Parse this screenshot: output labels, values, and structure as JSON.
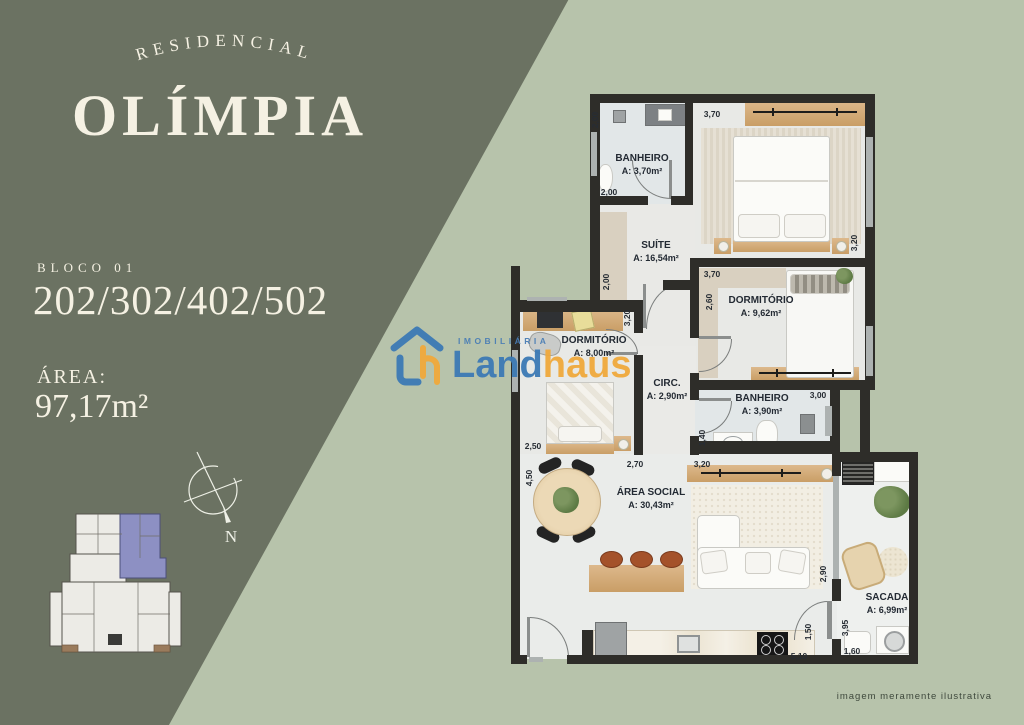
{
  "panel": {
    "arc_title": "RESIDENCIAL",
    "title": "OLÍMPIA",
    "bloco": "BLOCO 01",
    "units": "202/302/402/502",
    "area_label": "ÁREA:",
    "area_value": "97,17m²",
    "compass_n": "N"
  },
  "watermark": {
    "top": "IMOBILIÁRIA",
    "part1": "Land",
    "part2": "haus"
  },
  "footer": {
    "disclaimer": "imagem meramente ilustrativa"
  },
  "colors": {
    "dark_green": "#6b7262",
    "light_green": "#b7c3ab",
    "cream": "#f5f1e3",
    "wall": "#2e2d29",
    "logo_blue": "#3c7ab5",
    "logo_orange": "#f0a93c",
    "keyplan_highlight": "#8d90c3"
  },
  "plan": {
    "rooms": [
      {
        "name": "BANHEIRO",
        "area": "A: 3,70m²"
      },
      {
        "name": "SUÍTE",
        "area": "A: 16,54m²"
      },
      {
        "name": "DORMITÓRIO",
        "area": "A: 9,62m²"
      },
      {
        "name": "DORMITÓRIO",
        "area": "A: 8,00m²"
      },
      {
        "name": "CIRC.",
        "area": "A: 2,90m²"
      },
      {
        "name": "BANHEIRO",
        "area": "A: 3,90m²"
      },
      {
        "name": "ÁREA SOCIAL",
        "area": "A: 30,43m²"
      },
      {
        "name": "SACADA",
        "area": "A: 6,99m²"
      }
    ],
    "dims": [
      "2,00",
      "2,00",
      "3,70",
      "3,20",
      "2,00",
      "3,70",
      "2,60",
      "3,20",
      "2,50",
      "2,70",
      "3,20",
      "3,00",
      "1,40",
      "4,50",
      "2,90",
      "1,50",
      "5,10",
      "3,95",
      "1,60"
    ]
  }
}
